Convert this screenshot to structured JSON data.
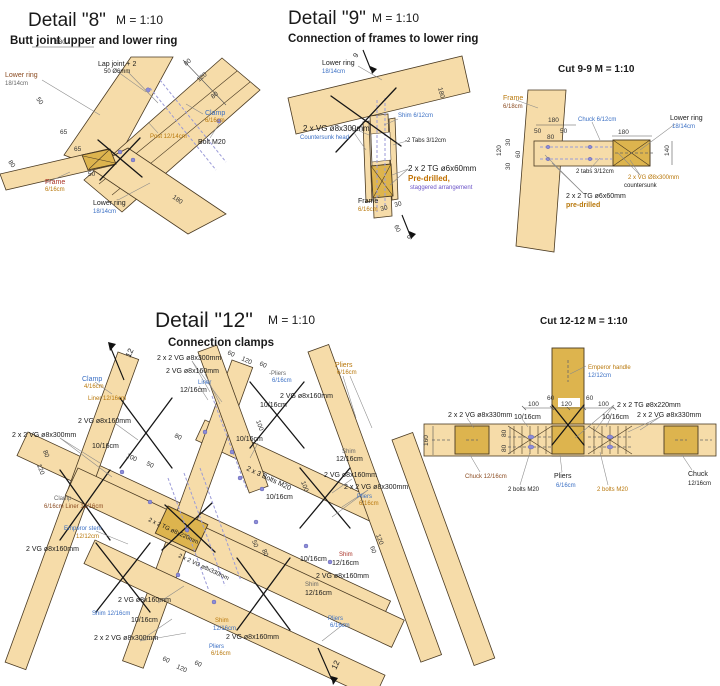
{
  "palette": {
    "wood": "#F6DCA9",
    "wood_dark": "#DDB44E",
    "outline": "#4A3A22",
    "text_blue": "#3A6FC4",
    "text_orange": "#B8770A",
    "text_brown": "#8A4A1F",
    "text_red": "#A93226",
    "text_purple": "#6A52C7"
  },
  "d8": {
    "title": "Detail \"8\"",
    "scale": "M = 1:10",
    "subtitle": "Butt joint upper and lower ring",
    "lower_ring_left": "Lower ring",
    "lower_ring_left_size": "18/14cm",
    "lap_joint": "Lap joint + 2",
    "lap_joint_sub": "50 Ø6mm",
    "clamp": "Clamp",
    "clamp_size": "6/16cm",
    "bolt": "Bolt M20",
    "post": "Post 12/14cm",
    "frame": "Frame",
    "frame_size": "6/16cm",
    "lower_ring": "Lower ring",
    "lower_ring_size": "18/14cm",
    "dims": [
      "180",
      "80",
      "120",
      "80",
      "50",
      "65",
      "65",
      "50",
      "80",
      "180"
    ]
  },
  "d9": {
    "title": "Detail \"9\"",
    "scale": "M = 1:10",
    "subtitle": "Connection of frames to lower ring",
    "lower_ring": "Lower ring",
    "lower_ring_size": "18/14cm",
    "shim": "Shim 6/12cm",
    "vg": "2 x VG ø8x300mm",
    "vg_sub": "Countersunk head",
    "tabs": "-2 Tabs 3/12cm",
    "tg": "2 x 2 TG ø6x60mm",
    "predrilled": "Pre-drilled,",
    "staggered": "staggered arrangement",
    "frame": "Frame",
    "frame_size": "6/16cm",
    "cut_num": "9",
    "dims": [
      "180",
      "30",
      "30",
      "60"
    ]
  },
  "c99": {
    "title": "Cut 9-9 M = 1:10",
    "frame": "Frame",
    "frame_size": "6/18cm",
    "chuck": "Chuck 6/12cm",
    "lower_ring": "Lower ring",
    "lower_ring_size": "18/14cm",
    "tabs": "2 tabs 3/12cm",
    "vg": "2 x VG Ø8x300mm",
    "vg_sub": "countersunk",
    "tg": "2 x 2 TG ø6x60mm",
    "tg_sub": "pre-drilled",
    "dims": [
      "180",
      "50",
      "80",
      "50",
      "120",
      "30",
      "60",
      "30",
      "180",
      "140"
    ]
  },
  "d12": {
    "title": "Detail \"12\"",
    "scale": "M = 1:10",
    "subtitle": "Connection clamps",
    "cut_num": "12",
    "vg300_top": "2 x 2 VG ø8x300mm",
    "vg160_a": "2 VG ø8x160mm",
    "liner": "Liner",
    "liner_size": "12/16cm",
    "pliers_a": "-Pliers",
    "pliers_a_size": "6/16cm",
    "pliers_b": "Pliers",
    "pliers_b_size": "6/16cm",
    "clamp": "Clamp",
    "clamp_size": "4/16cm",
    "liner2": "Liner 12/16cm",
    "vg160_b": "2 VG ø8x160mm",
    "vg300_left": "2 x 2 VG ø8x300mm",
    "s1016_a": "10/16cm",
    "s1016_c": "10/16cm",
    "shim_a": "Shim",
    "shim_a_size": "12/16cm",
    "vg160_c": "2 VG ø8x160mm",
    "vg300_r": "2 x 2 VG ø8x300mm",
    "pliers_c": "Pliers",
    "pliers_c_size": "6/16cm",
    "bolts": "2 x 3 Bolts M20",
    "s1016_d": "10/16cm",
    "tg220": "2 x 2 TG ø8x220mm",
    "vg330": "2 x 2 VG ø8x330mm",
    "clamp2": "Clamp",
    "clamp2_size": "6/16cm Liner 12/16cm",
    "emperor": "Emperor stem",
    "emperor_size": "12/12cm",
    "vg160_d": "2 VG ø8x160mm",
    "vg160_e": "2 VG ø8x160mm",
    "shim_b": "Shim 12/16cm",
    "s1016_e": "10/16cm",
    "vg300_b": "2 x 2 VG ø8x300mm",
    "shim_c": "Shim",
    "shim_c_size": "12/16cm",
    "pliers_d": "Pliers",
    "pliers_d_size": "6/16cm",
    "vg160_f": "2 VG ø8x160mm",
    "shim_d": "Shim",
    "shim_d_size": "12/16cm",
    "s1016_f": "10/16cm",
    "vg160_g": "2 VG ø8x160mm",
    "shim_e": "Shim",
    "shim_e_size": "12/16cm",
    "pliers_e": "Pliers",
    "pliers_e_size": "6/16cm",
    "vg160_h": "2 VG ø8x160mm",
    "s1016_g": "10/16cm",
    "dims": [
      "60",
      "120",
      "60",
      "100",
      "50",
      "80",
      "100",
      "100",
      "60",
      "120",
      "60",
      "120",
      "60",
      "80",
      "120",
      "50",
      "80"
    ]
  },
  "c1212": {
    "title": "Cut 12-12 M = 1:10",
    "emperor": "Emperor handle",
    "emperor_size": "12/12cm",
    "tg": "2 x 2 TG ø8x220mm",
    "vg_l": "2 x 2 VG ø8x330mm",
    "vg_r": "2 x 2 VG ø8x330mm",
    "s1016_l": "10/16cm",
    "s1016_r": "10/16cm",
    "chuck_l": "Chuck 12/16cm",
    "bolts_l": "2 bolts M20",
    "bolts_r": "2 bolts M20",
    "pliers": "Pliers",
    "pliers_size": "6/16cm",
    "chuck_r": "Chuck",
    "chuck_r_size": "12/16cm",
    "dims": [
      "60",
      "120",
      "60",
      "100",
      "100",
      "160",
      "80",
      "80"
    ]
  }
}
